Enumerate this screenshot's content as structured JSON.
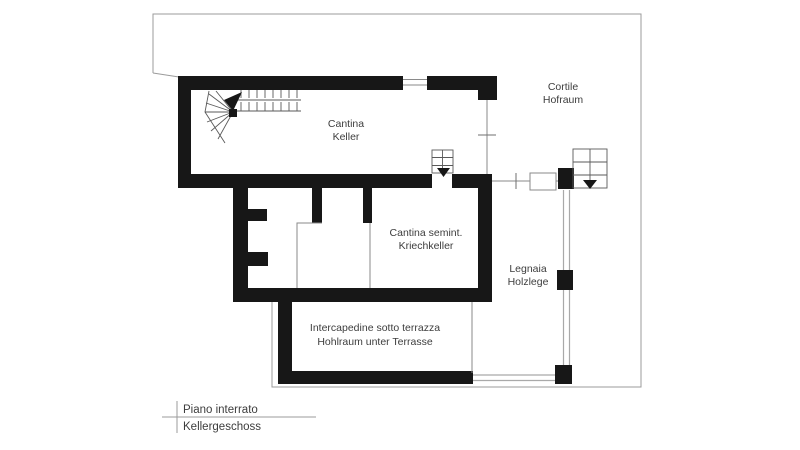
{
  "plan": {
    "type": "architectural-floor-plan",
    "title_block": {
      "line_it": "Piano interrato",
      "line_de": "Kellergeschoss"
    },
    "labels": {
      "cantina": {
        "it": "Cantina",
        "de": "Keller"
      },
      "cortile": {
        "it": "Cortile",
        "de": "Hofraum"
      },
      "cantina_semint": {
        "it": "Cantina semint.",
        "de": "Kriechkeller"
      },
      "legnaia": {
        "it": "Legnaia",
        "de": "Holzlege"
      },
      "intercapedine": {
        "it": "Intercapedine sotto terrazza",
        "de": "Hohlraum unter Terrasse"
      }
    },
    "colors": {
      "wall": "#171717",
      "boundary_line": "#9b9b9b",
      "detail_line": "#8a8a8a",
      "stair_line": "#5a5a5a",
      "text": "#3d3d3d",
      "background": "#ffffff"
    }
  }
}
